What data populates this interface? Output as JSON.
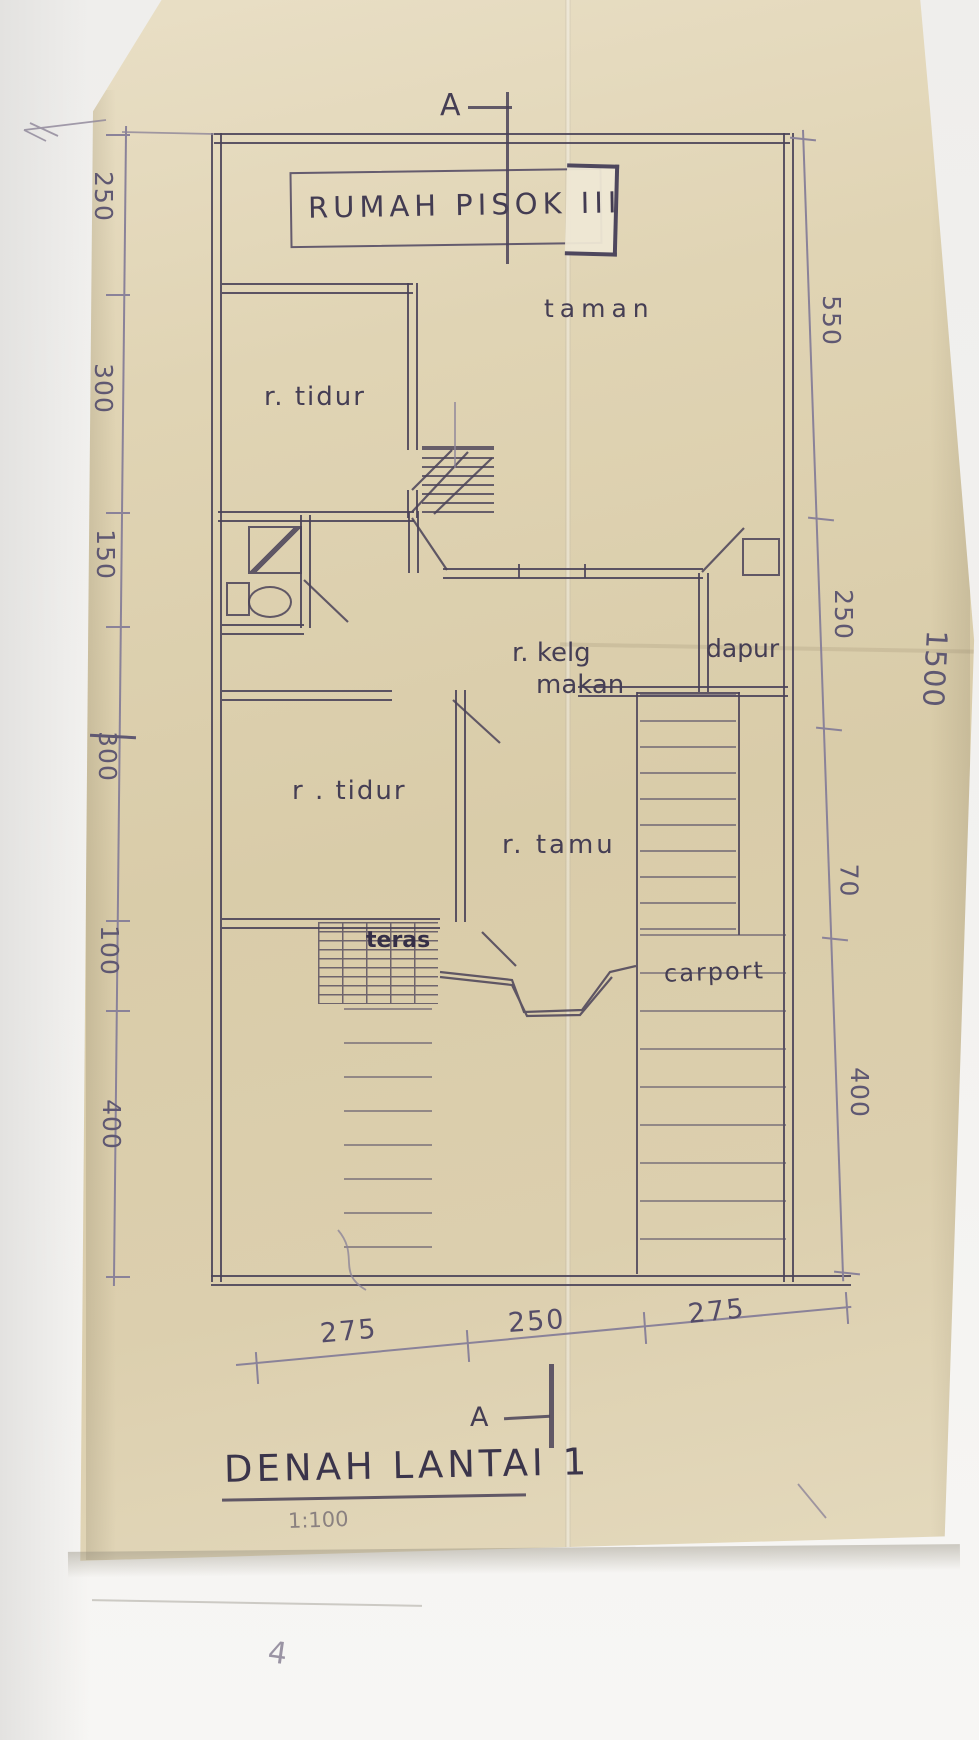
{
  "document": {
    "plan_title": "RUMAH PISOK III",
    "drawing_title": "DENAH LANTAI 1",
    "scale": "1:100",
    "section_marker": "A"
  },
  "rooms": {
    "garden": "taman",
    "bedroom_upper": "r. tidur",
    "family_dining_line1": "r. kelg",
    "family_dining_line2": "makan",
    "kitchen": "dapur",
    "bedroom_lower": "r . tidur",
    "living": "r. tamu",
    "terrace": "teras",
    "carport": "carport"
  },
  "dimensions": {
    "left": [
      "250",
      "300",
      "150",
      "300",
      "100",
      "400"
    ],
    "right": [
      "550",
      "250",
      "70",
      "400"
    ],
    "bottom": [
      "275",
      "250",
      "275"
    ],
    "overall_left": "1500",
    "overall_right": "1500"
  },
  "misc": {
    "corner_mark": "4"
  },
  "colors": {
    "ink": "#4a4258",
    "pencil": "#8a8299",
    "paper": "#d9cca9"
  }
}
